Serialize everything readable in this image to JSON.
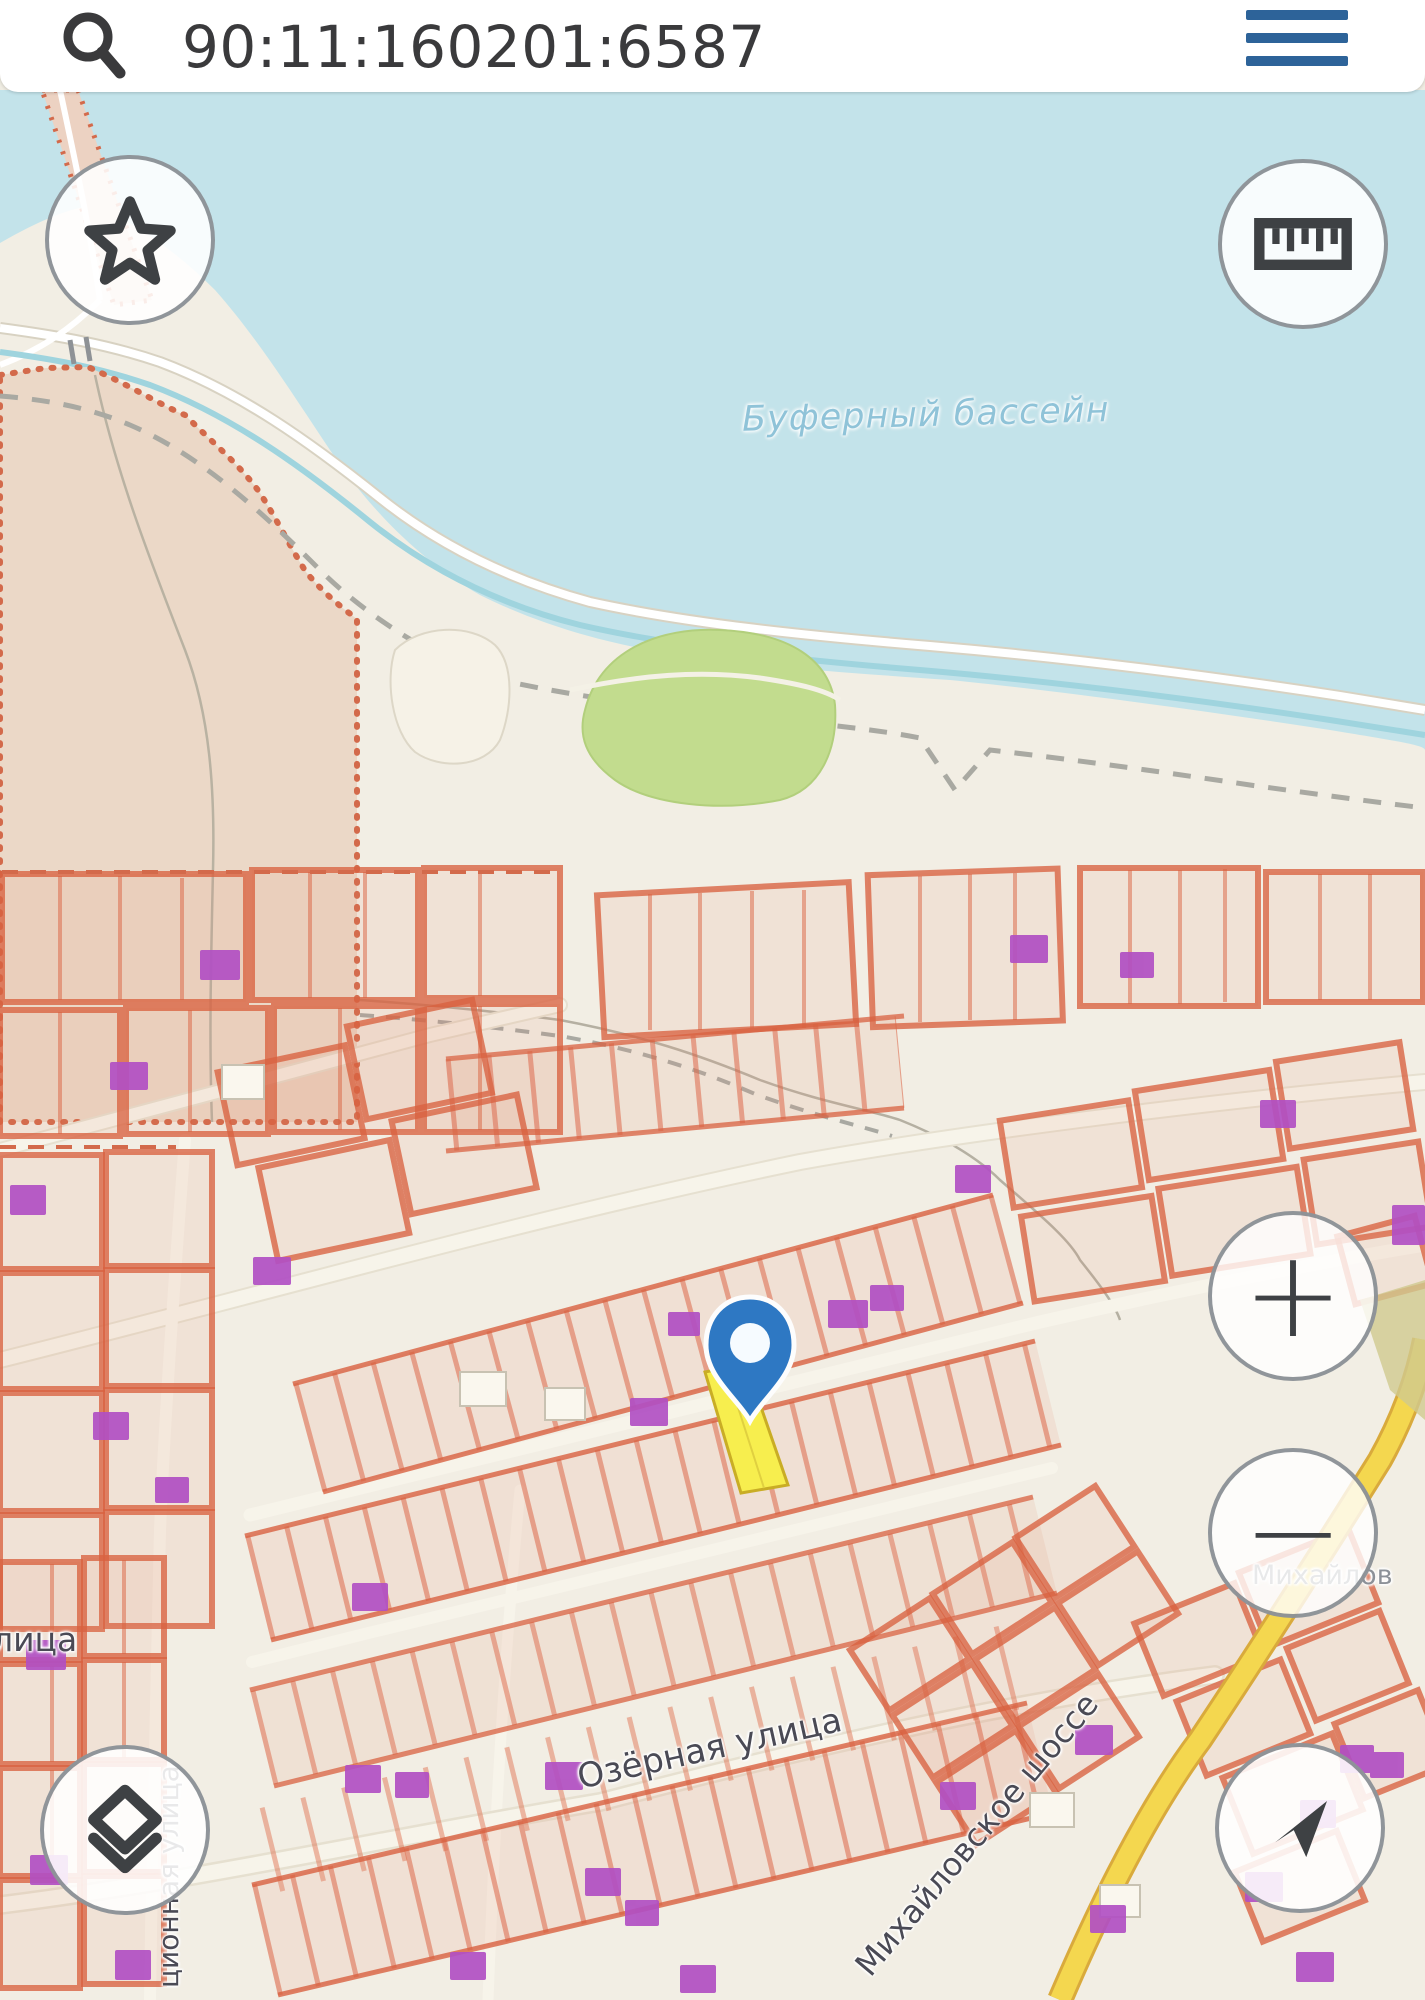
{
  "header": {
    "search_value": "90:11:160201:6587",
    "search_icon": "magnifier",
    "menu_icon": "hamburger"
  },
  "map": {
    "water_label": "Буферный бассейн",
    "streets": {
      "ozernaya": "Озёрная улица",
      "mikhailovskoe": "Михайловское шоссе",
      "litsa_partial": "лица",
      "tsionnaya_partial": "ционная улица"
    },
    "places": {
      "mikhailov_partial": "Михайлов"
    },
    "controls": {
      "zoom_in": "+",
      "zoom_out": "−",
      "favorites_icon": "star",
      "measure_icon": "ruler",
      "layers_icon": "layers",
      "locate_icon": "compass-arrow"
    },
    "marker": {
      "type": "pin",
      "highlighted_parcel": "yellow-strip"
    },
    "colors": {
      "water": "#c3e3ea",
      "land": "#f2eee4",
      "large_parcel_fill": "#ebd8c7",
      "parcel_outline": "#d96240",
      "building": "#b14fc3",
      "park": "#c2dc8e",
      "road_yellow": "#f4d74f",
      "highlight_parcel": "#f7ee4e",
      "pin": "#2e78c3",
      "menu_icon_color": "#2d6399",
      "icon_color": "#3e4144"
    }
  }
}
